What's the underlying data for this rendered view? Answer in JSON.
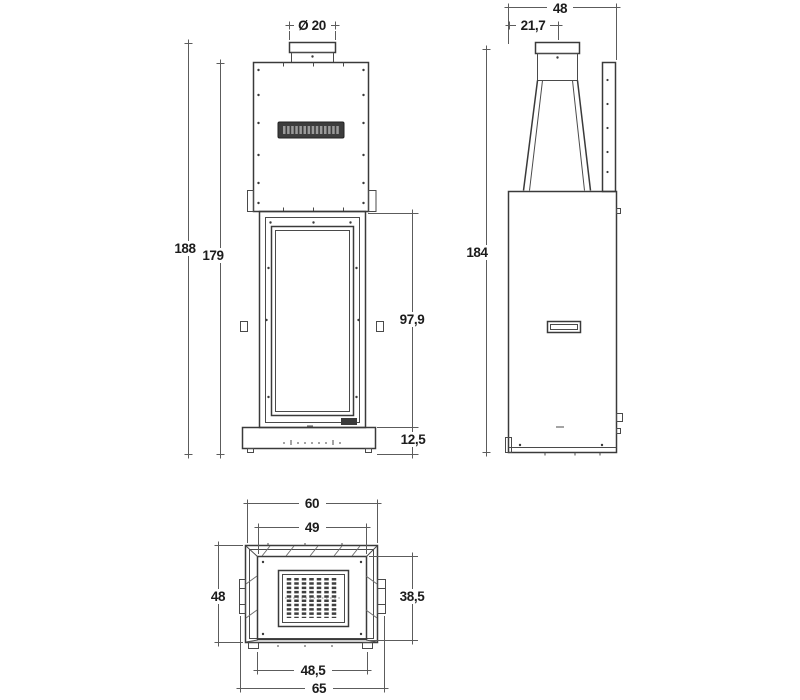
{
  "drawing": {
    "title": "fireplace-insert-dimension-drawing",
    "background_color": "#ffffff",
    "line_color": "#3a3a3a",
    "dimension_line_color": "#5c5c5c",
    "label_color": "#1c1c1c",
    "brand_plate_color": "#3d3d3d",
    "views": {
      "front": {
        "dims": {
          "flue_diameter": "Ø 20",
          "overall_height": "188",
          "body_height": "179",
          "firebox_height": "97,9",
          "plinth_height": "12,5"
        }
      },
      "side": {
        "dims": {
          "depth": "48",
          "flue_offset": "21,7",
          "overall_height": "184"
        }
      },
      "bottom": {
        "dims": {
          "outer_width": "60",
          "opening_width": "49",
          "outer_depth": "48",
          "opening_depth": "38,5",
          "base_width": "48,5",
          "overall_width": "65"
        }
      }
    }
  }
}
